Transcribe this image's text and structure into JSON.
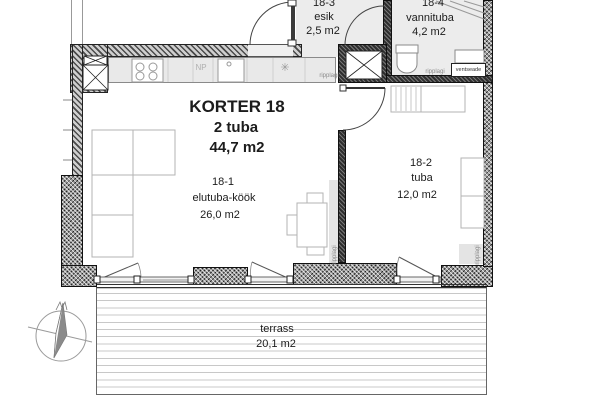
{
  "apartment": {
    "title": "KORTER 18",
    "rooms_count": "2 tuba",
    "total_area": "44,7 m2"
  },
  "rooms": [
    {
      "number": "18-1",
      "name": "elutuba-köök",
      "area": "26,0 m2"
    },
    {
      "number": "18-2",
      "name": "tuba",
      "area": "12,0 m2"
    },
    {
      "number": "18-3",
      "name": "esik",
      "area": "2,5 m2"
    },
    {
      "number": "18-4",
      "name": "vannituba",
      "area": "4,2 m2"
    }
  ],
  "terrace": {
    "name": "terrass",
    "area": "20,1 m2"
  },
  "annotations": {
    "np": "NP",
    "ripplagi": "ripplagi",
    "ventseade": "ventseade",
    "fridge_symbol": "✳"
  },
  "colors": {
    "wall_hatch": "#4a4a4a",
    "wall_dark": "#2e2e2e",
    "floor_gray": "#ececec",
    "furniture_line": "#b3b3b3",
    "deck_line": "#c8c8c8"
  }
}
